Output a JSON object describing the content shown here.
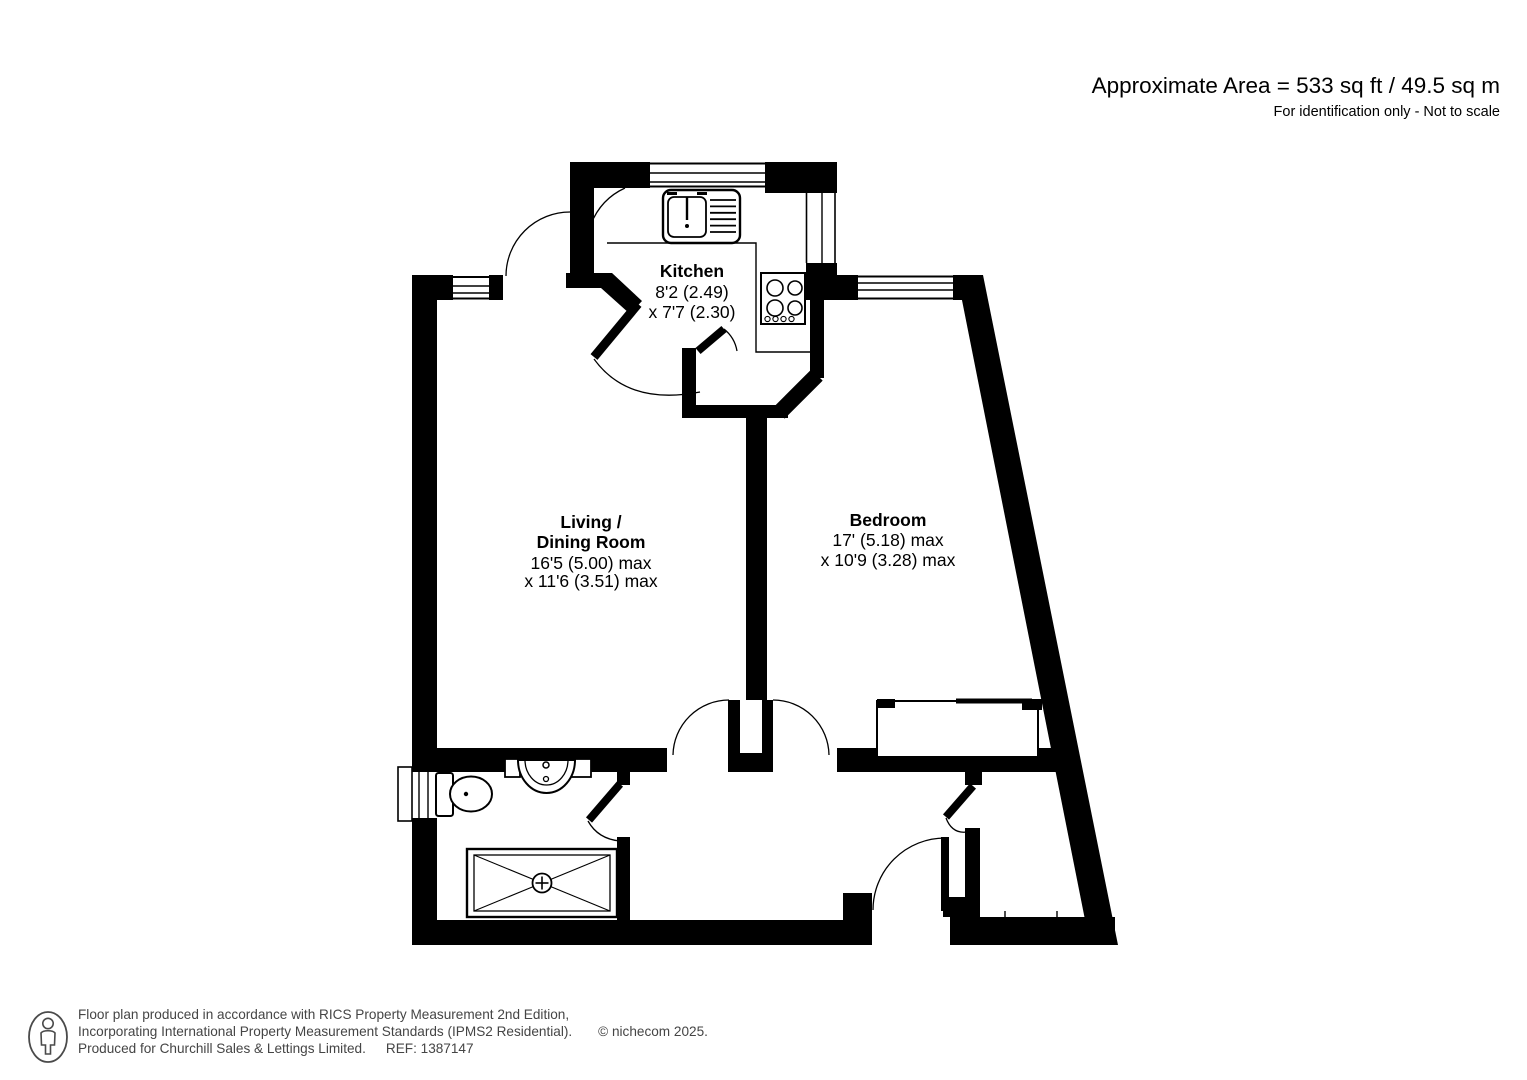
{
  "header": {
    "area": "Approximate Area = 533 sq ft / 49.5 sq m",
    "note": "For identification only - Not to scale"
  },
  "rooms": {
    "kitchen": {
      "name": "Kitchen",
      "dim1": "8'2 (2.49)",
      "dim2": "x 7'7 (2.30)"
    },
    "living": {
      "name1": "Living /",
      "name2": "Dining Room",
      "dim1": "16'5 (5.00) max",
      "dim2": "x 11'6 (3.51) max"
    },
    "bedroom": {
      "name": "Bedroom",
      "dim1": "17' (5.18) max",
      "dim2": "x 10'9 (3.28) max"
    }
  },
  "footer": {
    "line1": "Floor plan produced in accordance with RICS Property Measurement 2nd Edition,",
    "line2": "Incorporating International Property Measurement Standards (IPMS2 Residential).",
    "copyright": "© nichecom 2025.",
    "line3": "Produced for Churchill Sales & Lettings Limited.",
    "ref": "REF: 1387147"
  },
  "colors": {
    "wall": "#000000",
    "footer_text": "#454545"
  }
}
